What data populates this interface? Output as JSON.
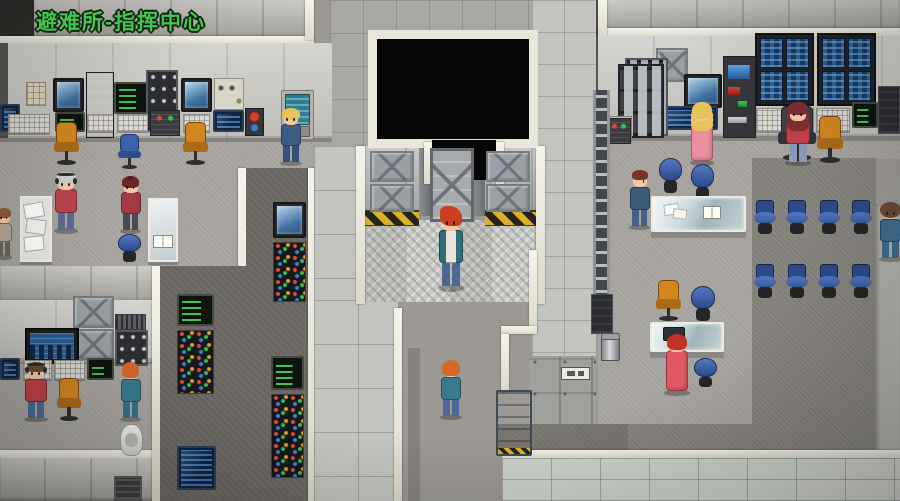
{
  "hud": {
    "location_label": "避难所-指挥中心",
    "label_color": "#45c44f"
  },
  "palette": {
    "trim_white": "#eee9dc",
    "floor_light": "#a8a5a0",
    "floor_dark": "#86837d",
    "hazard_yellow": "#d9b325",
    "chair_orange": "#d3861f",
    "chair_blue": "#3a62ae",
    "screen_blue": "#163b66",
    "terminal_green": "#48e060",
    "void_black": "#060606"
  },
  "entities": {
    "equipment": [
      {
        "id": "keypad-left",
        "type": "keypad",
        "x": 26,
        "y": 82,
        "w": 20,
        "h": 24
      },
      {
        "id": "cam-monitor-1",
        "type": "cam-monitor",
        "x": 53,
        "y": 78,
        "w": 31,
        "h": 34
      },
      {
        "id": "locker-left",
        "type": "locker-dark",
        "x": 86,
        "y": 72,
        "w": 28,
        "h": 66
      },
      {
        "id": "green-terminal-1",
        "type": "green-terminal",
        "x": 114,
        "y": 82,
        "w": 34,
        "h": 32
      },
      {
        "id": "breaker-panel-1",
        "type": "breaker-panel",
        "x": 146,
        "y": 70,
        "w": 32,
        "h": 62
      },
      {
        "id": "cam-monitor-2",
        "type": "cam-monitor",
        "x": 181,
        "y": 78,
        "w": 31,
        "h": 34
      },
      {
        "id": "switch-panel-1",
        "type": "switch-panel",
        "x": 214,
        "y": 78,
        "w": 30,
        "h": 32
      },
      {
        "id": "console-blue-0",
        "type": "console-blue",
        "x": 0,
        "y": 104,
        "w": 20,
        "h": 28
      },
      {
        "id": "keyboard-1",
        "type": "keyboard",
        "x": 8,
        "y": 114,
        "w": 42,
        "h": 20
      },
      {
        "id": "green-screen-path",
        "type": "green-terminal",
        "x": 55,
        "y": 112,
        "w": 30,
        "h": 20
      },
      {
        "id": "keyboard-2",
        "type": "keyboard",
        "x": 87,
        "y": 114,
        "w": 27,
        "h": 18
      },
      {
        "id": "keyboard-3",
        "type": "keyboard",
        "x": 117,
        "y": 114,
        "w": 31,
        "h": 18
      },
      {
        "id": "mini-console-1",
        "type": "mini-console",
        "x": 150,
        "y": 110,
        "w": 30,
        "h": 26
      },
      {
        "id": "keyboard-4",
        "type": "keyboard",
        "x": 183,
        "y": 114,
        "w": 27,
        "h": 18
      },
      {
        "id": "console-blue-1",
        "type": "console-blue",
        "x": 213,
        "y": 110,
        "w": 31,
        "h": 22
      },
      {
        "id": "red-console-1",
        "type": "red-console",
        "x": 245,
        "y": 108,
        "w": 19,
        "h": 28
      },
      {
        "id": "teal-terminal-1",
        "type": "teal-terminal",
        "x": 281,
        "y": 90,
        "w": 33,
        "h": 50
      },
      {
        "id": "gauge-panel-1",
        "type": "gauge-panel",
        "x": 606,
        "y": 116,
        "w": 26,
        "h": 26
      },
      {
        "id": "fuse-cabinet-1",
        "type": "fuse-cabinet",
        "x": 625,
        "y": 58,
        "w": 43,
        "h": 78
      },
      {
        "id": "xpanel-right-wall",
        "type": "xpanel",
        "x": 656,
        "y": 48,
        "w": 32,
        "h": 34
      },
      {
        "id": "cam-monitor-3",
        "type": "cam-monitor",
        "x": 684,
        "y": 74,
        "w": 38,
        "h": 34
      },
      {
        "id": "console-blue-2",
        "type": "console-blue",
        "x": 663,
        "y": 106,
        "w": 55,
        "h": 24
      },
      {
        "id": "console-rack-1",
        "type": "console-rack",
        "x": 723,
        "y": 56,
        "w": 33,
        "h": 82
      },
      {
        "id": "monitor-bank-1",
        "type": "monitor-bank",
        "x": 755,
        "y": 33,
        "w": 59,
        "h": 73
      },
      {
        "id": "monitor-bank-2",
        "type": "monitor-bank",
        "x": 817,
        "y": 33,
        "w": 59,
        "h": 73
      },
      {
        "id": "keyboard-5",
        "type": "keyboard",
        "x": 756,
        "y": 108,
        "w": 58,
        "h": 24
      },
      {
        "id": "keyboard-6",
        "type": "keyboard",
        "x": 816,
        "y": 108,
        "w": 34,
        "h": 24
      },
      {
        "id": "green-terminal-3",
        "type": "green-terminal",
        "x": 852,
        "y": 102,
        "w": 26,
        "h": 26
      },
      {
        "id": "dark-rack-right",
        "type": "dark-rack",
        "x": 878,
        "y": 86,
        "w": 22,
        "h": 48
      },
      {
        "id": "xpanel-bl-1",
        "type": "xpanel",
        "x": 73,
        "y": 296,
        "w": 41,
        "h": 32
      },
      {
        "id": "xpanel-bl-2",
        "type": "xpanel",
        "x": 73,
        "y": 329,
        "w": 41,
        "h": 31
      },
      {
        "id": "vent-1",
        "type": "vent",
        "x": 115,
        "y": 314,
        "w": 31,
        "h": 16
      },
      {
        "id": "breaker-panel-2",
        "type": "breaker-panel",
        "x": 115,
        "y": 330,
        "w": 33,
        "h": 36
      },
      {
        "id": "wall-monitor-bl",
        "type": "monitor-large",
        "x": 25,
        "y": 328,
        "w": 54,
        "h": 36
      },
      {
        "id": "console-blue-3",
        "type": "console-blue",
        "x": 0,
        "y": 358,
        "w": 20,
        "h": 22
      },
      {
        "id": "keyboard-7",
        "type": "keyboard",
        "x": 23,
        "y": 360,
        "w": 29,
        "h": 20
      },
      {
        "id": "keyboard-8",
        "type": "keyboard",
        "x": 54,
        "y": 360,
        "w": 31,
        "h": 20
      },
      {
        "id": "green-terminal-4",
        "type": "green-terminal",
        "x": 87,
        "y": 358,
        "w": 27,
        "h": 22
      },
      {
        "id": "hatch-1",
        "type": "hatch",
        "x": 114,
        "y": 476,
        "w": 28,
        "h": 25
      },
      {
        "id": "cam-monitor-4",
        "type": "cam-monitor",
        "x": 273,
        "y": 202,
        "w": 33,
        "h": 36
      },
      {
        "id": "led-rack-1",
        "type": "led-rack",
        "x": 273,
        "y": 242,
        "w": 33,
        "h": 60
      },
      {
        "id": "green-terminal-5",
        "type": "green-terminal",
        "x": 177,
        "y": 294,
        "w": 37,
        "h": 32
      },
      {
        "id": "led-rack-2",
        "type": "led-rack",
        "x": 177,
        "y": 330,
        "w": 37,
        "h": 64
      },
      {
        "id": "console-blue-4",
        "type": "console-blue",
        "x": 177,
        "y": 446,
        "w": 39,
        "h": 44
      },
      {
        "id": "green-terminal-6",
        "type": "green-terminal",
        "x": 271,
        "y": 356,
        "w": 33,
        "h": 34
      },
      {
        "id": "led-rack-3",
        "type": "led-rack",
        "x": 271,
        "y": 394,
        "w": 33,
        "h": 84
      },
      {
        "id": "ladder-1",
        "type": "ladder",
        "x": 593,
        "y": 90,
        "w": 17,
        "h": 242
      },
      {
        "id": "ladder-cabinet",
        "type": "dark-rack",
        "x": 591,
        "y": 294,
        "w": 22,
        "h": 40
      },
      {
        "id": "trash-can-1",
        "type": "trash-can",
        "x": 601,
        "y": 334,
        "w": 19,
        "h": 27
      },
      {
        "id": "machine-1",
        "type": "machine",
        "x": 618,
        "y": 64,
        "w": 46,
        "h": 74
      },
      {
        "id": "mini-console-2",
        "type": "mini-console",
        "x": 607,
        "y": 118,
        "w": 24,
        "h": 26
      },
      {
        "id": "wall-sign",
        "type": "sign",
        "x": 561,
        "y": 367,
        "w": 29,
        "h": 13
      },
      {
        "id": "lower-door",
        "type": "lower-door",
        "x": 496,
        "y": 390,
        "w": 36,
        "h": 66
      },
      {
        "id": "xpanel-elev-1",
        "type": "xpanel",
        "x": 370,
        "y": 151,
        "w": 44,
        "h": 31
      },
      {
        "id": "xpanel-elev-2",
        "type": "xpanel",
        "x": 370,
        "y": 184,
        "w": 44,
        "h": 28
      },
      {
        "id": "xpanel-elev-3",
        "type": "xpanel",
        "x": 486,
        "y": 151,
        "w": 44,
        "h": 31
      },
      {
        "id": "xpanel-elev-4",
        "type": "xpanel",
        "x": 486,
        "y": 184,
        "w": 44,
        "h": 28
      },
      {
        "id": "elevator-door",
        "type": "elevator-door",
        "x": 430,
        "y": 148,
        "w": 44,
        "h": 74
      }
    ],
    "furniture": [
      {
        "id": "office-chair-left-1",
        "type": "office-chair",
        "color": "#d3861f",
        "x": 53,
        "y": 122,
        "w": 27,
        "h": 44
      },
      {
        "id": "office-chair-left-2",
        "type": "office-chair",
        "color": "#3a62ae",
        "x": 118,
        "y": 134,
        "w": 23,
        "h": 36
      },
      {
        "id": "office-chair-left-3",
        "type": "office-chair",
        "color": "#d3861f",
        "x": 182,
        "y": 122,
        "w": 27,
        "h": 44
      },
      {
        "id": "paper-cart",
        "type": "paper-cart",
        "x": 20,
        "y": 196,
        "w": 32,
        "h": 66
      },
      {
        "id": "book-stand",
        "type": "book-stand",
        "x": 148,
        "y": 198,
        "w": 30,
        "h": 64
      },
      {
        "id": "stool-left",
        "type": "stool",
        "x": 118,
        "y": 234,
        "w": 23,
        "h": 30
      },
      {
        "id": "office-chair-bl",
        "type": "office-chair",
        "color": "#d3861f",
        "x": 56,
        "y": 378,
        "w": 26,
        "h": 44
      },
      {
        "id": "toilet",
        "type": "toilet",
        "x": 120,
        "y": 424,
        "w": 23,
        "h": 32
      },
      {
        "id": "stool-r1",
        "type": "stool",
        "x": 659,
        "y": 158,
        "w": 23,
        "h": 38
      },
      {
        "id": "stool-r2",
        "type": "stool",
        "x": 691,
        "y": 164,
        "w": 23,
        "h": 40
      },
      {
        "id": "desk-chair-dark",
        "type": "office-chair",
        "color": "#3c3f4a",
        "x": 777,
        "y": 106,
        "w": 40,
        "h": 56
      },
      {
        "id": "office-chair-right-1",
        "type": "office-chair",
        "color": "#d3861f",
        "x": 816,
        "y": 116,
        "w": 28,
        "h": 48
      },
      {
        "id": "glass-table-1",
        "type": "glass-table",
        "props": [
          "papers",
          "book"
        ],
        "x": 651,
        "y": 196,
        "w": 95,
        "h": 36
      },
      {
        "id": "office-chair-right-2",
        "type": "office-chair",
        "color": "#d3861f",
        "x": 655,
        "y": 280,
        "w": 27,
        "h": 42
      },
      {
        "id": "stool-r3",
        "type": "stool",
        "x": 691,
        "y": 286,
        "w": 24,
        "h": 38
      },
      {
        "id": "glass-table-2",
        "type": "glass-table",
        "props": [
          "laptop"
        ],
        "x": 650,
        "y": 322,
        "w": 74,
        "h": 30
      },
      {
        "id": "stool-r4",
        "type": "stool",
        "x": 694,
        "y": 358,
        "w": 23,
        "h": 32
      },
      {
        "id": "meeting-chair-1",
        "type": "meeting-chair",
        "x": 753,
        "y": 200,
        "w": 24,
        "h": 36
      },
      {
        "id": "meeting-chair-2",
        "type": "meeting-chair",
        "x": 785,
        "y": 200,
        "w": 24,
        "h": 36
      },
      {
        "id": "meeting-chair-3",
        "type": "meeting-chair",
        "x": 817,
        "y": 200,
        "w": 24,
        "h": 36
      },
      {
        "id": "meeting-chair-4",
        "type": "meeting-chair",
        "x": 849,
        "y": 200,
        "w": 24,
        "h": 36
      },
      {
        "id": "meeting-chair-5",
        "type": "meeting-chair",
        "x": 753,
        "y": 264,
        "w": 24,
        "h": 36
      },
      {
        "id": "meeting-chair-6",
        "type": "meeting-chair",
        "x": 785,
        "y": 264,
        "w": 24,
        "h": 36
      },
      {
        "id": "meeting-chair-7",
        "type": "meeting-chair",
        "x": 817,
        "y": 264,
        "w": 24,
        "h": 36
      },
      {
        "id": "meeting-chair-8",
        "type": "meeting-chair",
        "x": 849,
        "y": 264,
        "w": 24,
        "h": 36
      }
    ],
    "npcs": [
      {
        "id": "npc-console-blonde",
        "x": 278,
        "y": 108,
        "w": 26,
        "h": 58,
        "facing": "down",
        "hairstyle": "bob",
        "hair": "#e6c35c",
        "outfit": "#3c5c86",
        "legs": "#35507a",
        "variant": "suit"
      },
      {
        "id": "npc-pink-robe",
        "x": 688,
        "y": 102,
        "w": 28,
        "h": 64,
        "facing": "up",
        "hairstyle": "long",
        "hair": "#e6c35c",
        "outfit": "#e98fa0",
        "variant": "robe"
      },
      {
        "id": "npc-seated-red-jacket",
        "x": 783,
        "y": 102,
        "w": 30,
        "h": 64,
        "facing": "down",
        "hairstyle": "long",
        "hair": "#7e2e34",
        "outfit": "#c14048",
        "legs": "#8a97b8",
        "variant": "suit"
      },
      {
        "id": "npc-elder-headphones",
        "x": 52,
        "y": 172,
        "w": 28,
        "h": 62,
        "facing": "down",
        "hairstyle": "bob",
        "hair": "#cfcfcf",
        "outfit": "#b8454d",
        "legs": "#5d6d92",
        "variant": "suit",
        "headphones": true
      },
      {
        "id": "npc-maroon-woman",
        "x": 118,
        "y": 176,
        "w": 25,
        "h": 58,
        "facing": "down",
        "hairstyle": "bun",
        "hair": "#6e2428",
        "outfit": "#a23a44",
        "legs": "#4a4a52",
        "variant": "suit"
      },
      {
        "id": "npc-edge-partial",
        "x": -6,
        "y": 208,
        "w": 20,
        "h": 52,
        "facing": "down",
        "hairstyle": "bob",
        "hair": "#8a5a38",
        "outfit": "#b3a893",
        "legs": "#6a665e",
        "variant": "suit"
      },
      {
        "id": "npc-navy-profile",
        "x": 627,
        "y": 170,
        "w": 25,
        "h": 60,
        "facing": "right",
        "hairstyle": "short",
        "hair": "#7a332b",
        "outfit": "#3d5a78",
        "legs": "#45618a",
        "variant": "suit"
      },
      {
        "id": "npc-curly-right-edge",
        "x": 877,
        "y": 202,
        "w": 27,
        "h": 60,
        "facing": "down",
        "hairstyle": "curly",
        "hair": "#6b4b33",
        "outfit": "#3f6b8e",
        "legs": "#3f6b8e",
        "variant": "suit"
      },
      {
        "id": "npc-red-dress",
        "x": 662,
        "y": 334,
        "w": 30,
        "h": 62,
        "facing": "up",
        "hairstyle": "bob",
        "hair": "#c23227",
        "outfit": "#e25868",
        "variant": "robe"
      },
      {
        "id": "npc-headphones-man",
        "x": 22,
        "y": 362,
        "w": 28,
        "h": 60,
        "facing": "down",
        "hairstyle": "short",
        "hair": "#6b4b33",
        "outfit": "#c14048",
        "legs": "#4a6a9a",
        "variant": "suit",
        "headphones": true
      },
      {
        "id": "npc-console-woman",
        "x": 118,
        "y": 362,
        "w": 25,
        "h": 60,
        "facing": "up",
        "hairstyle": "bob",
        "hair": "#d3692b",
        "outfit": "#3b7a8c",
        "legs": "#35708a",
        "variant": "suit"
      },
      {
        "id": "npc-corridor-walker",
        "x": 438,
        "y": 360,
        "w": 26,
        "h": 60,
        "facing": "up",
        "hairstyle": "bob",
        "hair": "#d3692b",
        "outfit": "#3b7a8c",
        "legs": "#4a6a9a",
        "variant": "suit"
      }
    ],
    "player": {
      "id": "player-character",
      "x": 436,
      "y": 206,
      "w": 30,
      "h": 86,
      "facing": "down",
      "hairstyle": "spiky",
      "hair": "#cf3d1f",
      "outfit": "#2f6d78",
      "legs": "#4a6890",
      "variant": "suit",
      "jacket": true
    }
  }
}
